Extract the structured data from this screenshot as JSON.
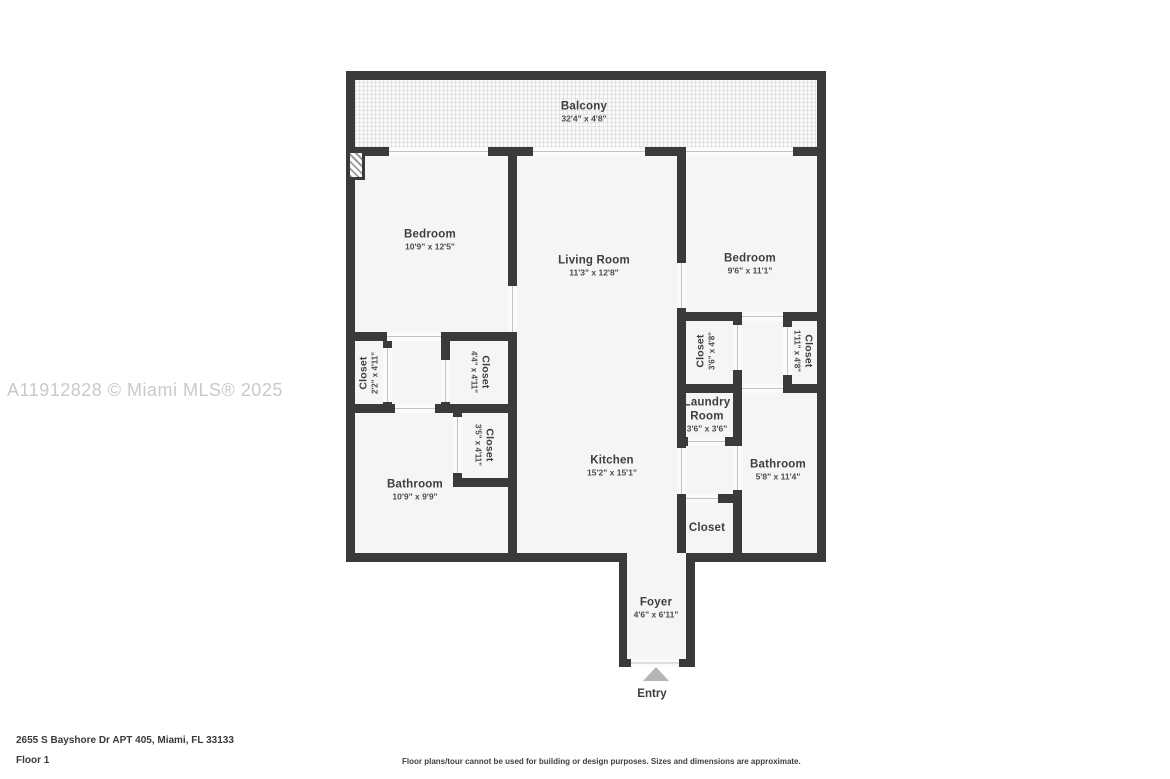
{
  "watermark": "A11912828 © Miami MLS® 2025",
  "entry_label": "Entry",
  "rooms": {
    "balcony": {
      "name": "Balcony",
      "dims": "32'4\" x 4'8\""
    },
    "bedroom_left": {
      "name": "Bedroom",
      "dims": "10'9\" x 12'5\""
    },
    "living_room": {
      "name": "Living Room",
      "dims": "11'3\" x 12'8\""
    },
    "bedroom_right": {
      "name": "Bedroom",
      "dims": "9'6\" x 11'1\""
    },
    "kitchen": {
      "name": "Kitchen",
      "dims": "15'2\" x 15'1\""
    },
    "bathroom_left": {
      "name": "Bathroom",
      "dims": "10'9\" x 9'9\""
    },
    "bathroom_right": {
      "name": "Bathroom",
      "dims": "5'8\" x 11'4\""
    },
    "laundry": {
      "name": "Laundry Room",
      "dims": "3'6\" x 3'6\""
    },
    "foyer": {
      "name": "Foyer",
      "dims": "4'6\" x 6'11\""
    },
    "closet_bed1_left": {
      "name": "Closet",
      "dims": "2'2\" x 4'11\""
    },
    "closet_bed1_right": {
      "name": "Closet",
      "dims": "4'4\" x 4'11\""
    },
    "closet_bath1": {
      "name": "Closet",
      "dims": "3'5\" x 4'11\""
    },
    "closet_bed2_left": {
      "name": "Closet",
      "dims": "3'6\" x 4'8\""
    },
    "closet_bed2_right": {
      "name": "Closet",
      "dims": "1'11\" x 4'8\""
    },
    "closet_hall": {
      "name": "Closet",
      "dims": ""
    }
  },
  "footer": {
    "address": "2655 S Bayshore Dr APT 405, Miami, FL 33133",
    "floor": "Floor 1",
    "disclaimer": "Floor plans/tour cannot be used for building or design purposes. Sizes and dimensions are approximate."
  }
}
